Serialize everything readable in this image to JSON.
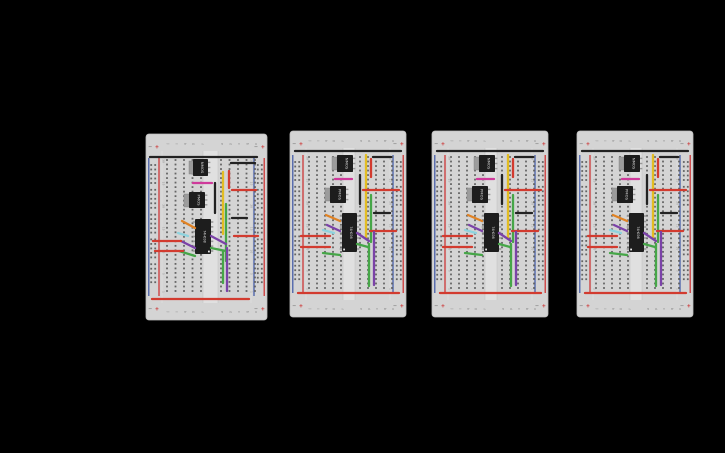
{
  "canvas": {
    "width": 725,
    "height": 453,
    "background": "#000000"
  },
  "colors": {
    "board_body": "#d4d4d4",
    "board_edge": "#bdbdbd",
    "seam": "#e3e3e3",
    "channel": "#e0e0e0",
    "channel_edge": "#c3c3c3",
    "hole": "#646464",
    "rail_red": "#cc2b2b",
    "rail_blue": "#3b55a5",
    "label_text": "#8a8a8a",
    "minus_text": "#5a5a5a",
    "chip_body": "#1d1d1d",
    "chip_tab": "#9c9c9c",
    "chip_pin": "#999999",
    "chip_text": "#dcdcdc",
    "chip_dot": "#e8e8e8"
  },
  "wire_colors": {
    "black": "#222222",
    "red": "#d23b2f",
    "magenta": "#cf3a9b",
    "yellow": "#e3bd22",
    "green": "#46a648",
    "purple": "#7b42a8",
    "orange": "#e08224",
    "cyan": "#8ed3de"
  },
  "breadboard_labels": {
    "rail_positive": "+",
    "rail_negative": "−",
    "column_letters_left": [
      "j",
      "i",
      "h",
      "g",
      "f"
    ],
    "column_letters_right": [
      "e",
      "d",
      "c",
      "b",
      "a"
    ],
    "row_numbers_top_to_bottom": [
      "30",
      "25",
      "20",
      "15",
      "10",
      "5",
      "1"
    ]
  },
  "boards": [
    {
      "name": "breadboard-1",
      "x": 146,
      "y": 134,
      "w": 121,
      "h": 186,
      "variant": "A"
    },
    {
      "name": "breadboard-2",
      "x": 290,
      "y": 131,
      "w": 116,
      "h": 186,
      "variant": "B"
    },
    {
      "name": "breadboard-3",
      "x": 432,
      "y": 131,
      "w": 116,
      "h": 186,
      "variant": "B"
    },
    {
      "name": "breadboard-4",
      "x": 577,
      "y": 131,
      "w": 116,
      "h": 186,
      "variant": "B"
    }
  ],
  "variants": {
    "A": {
      "leftCols": [
        21,
        29.5,
        38,
        46.5,
        55
      ],
      "rightCols": [
        75,
        83.5,
        92,
        100.5,
        109
      ],
      "channel": [
        57,
        72
      ],
      "chips": [
        {
          "kind": "to220",
          "label": "NMOS",
          "tab": {
            "x": 43,
            "y": 27,
            "w": 4.5,
            "h": 13
          },
          "body": {
            "x": 47,
            "y": 25,
            "w": 15,
            "h": 17
          }
        },
        {
          "kind": "to220",
          "label": "PMOS",
          "tab": {
            "x": 38,
            "y": 60,
            "w": 5,
            "h": 13
          },
          "body": {
            "x": 43,
            "y": 58,
            "w": 16,
            "h": 16
          }
        },
        {
          "kind": "dip14",
          "label": "74HC08",
          "body": {
            "x": 49,
            "y": 85,
            "w": 16,
            "h": 35
          },
          "dot": "br"
        }
      ],
      "wires": [
        [
          "black",
          4,
          23,
          111,
          23
        ],
        [
          "black",
          85,
          29,
          109,
          29
        ],
        [
          "red",
          83,
          37,
          83,
          54
        ],
        [
          "magenta",
          47,
          49,
          66,
          49
        ],
        [
          "black",
          69,
          49,
          69,
          79
        ],
        [
          "yellow",
          77,
          38,
          77,
          100
        ],
        [
          "red",
          86,
          56,
          110,
          56
        ],
        [
          "green",
          80,
          70,
          80,
          127
        ],
        [
          "black",
          86,
          84,
          101,
          84
        ],
        [
          "red",
          88,
          102,
          112,
          102
        ],
        [
          "orange",
          36,
          87,
          49,
          94
        ],
        [
          "cyan",
          32,
          99,
          42,
          102
        ],
        [
          "purple",
          35,
          107,
          49,
          114
        ],
        [
          "purple",
          65,
          102,
          80,
          110
        ],
        [
          "green",
          65,
          114,
          80,
          117
        ],
        [
          "green",
          33,
          117,
          49,
          122
        ],
        [
          "red",
          7,
          107,
          35,
          107
        ],
        [
          "red",
          9,
          117,
          37,
          117
        ],
        [
          "green",
          77,
          117,
          77,
          149
        ],
        [
          "purple",
          81,
          114,
          81,
          157
        ],
        [
          "red",
          6,
          165,
          103,
          165
        ]
      ]
    },
    "B": {
      "leftCols": [
        19,
        27,
        35,
        43,
        51
      ],
      "rightCols": [
        70,
        78,
        86,
        94,
        102
      ],
      "channel": [
        53,
        65
      ],
      "chips": [
        {
          "kind": "to220",
          "label": "NMOS",
          "tab": {
            "x": 42,
            "y": 26,
            "w": 5,
            "h": 13
          },
          "body": {
            "x": 47,
            "y": 24,
            "w": 16,
            "h": 17
          }
        },
        {
          "kind": "to220",
          "label": "PMOS",
          "tab": {
            "x": 35,
            "y": 57,
            "w": 5,
            "h": 13
          },
          "body": {
            "x": 40,
            "y": 55,
            "w": 16,
            "h": 17
          }
        },
        {
          "kind": "dip14",
          "label": "74HC08",
          "body": {
            "x": 52,
            "y": 82,
            "w": 15,
            "h": 39
          },
          "dot": "bl"
        }
      ],
      "wires": [
        [
          "black",
          5,
          20,
          111,
          20
        ],
        [
          "black",
          83,
          26,
          101,
          26
        ],
        [
          "red",
          81,
          28,
          81,
          46
        ],
        [
          "magenta",
          45,
          48,
          62,
          48
        ],
        [
          "black",
          70,
          44,
          70,
          73
        ],
        [
          "yellow",
          76,
          24,
          76,
          107
        ],
        [
          "red",
          73,
          59,
          109,
          59
        ],
        [
          "green",
          81,
          64,
          81,
          111
        ],
        [
          "black",
          84,
          82,
          100,
          82
        ],
        [
          "red",
          80,
          100,
          106,
          100
        ],
        [
          "orange",
          36,
          84,
          50,
          90
        ],
        [
          "purple",
          37,
          94,
          50,
          100
        ],
        [
          "cyan",
          33,
          99,
          44,
          102
        ],
        [
          "purple",
          67,
          102,
          79,
          110
        ],
        [
          "green",
          67,
          113,
          78,
          116
        ],
        [
          "green",
          33,
          122,
          50,
          124
        ],
        [
          "red",
          11,
          105,
          40,
          105
        ],
        [
          "red",
          11,
          116,
          40,
          116
        ],
        [
          "green",
          79,
          113,
          79,
          155
        ],
        [
          "purple",
          84,
          101,
          84,
          154
        ],
        [
          "red",
          8,
          162,
          109,
          162
        ]
      ]
    }
  }
}
